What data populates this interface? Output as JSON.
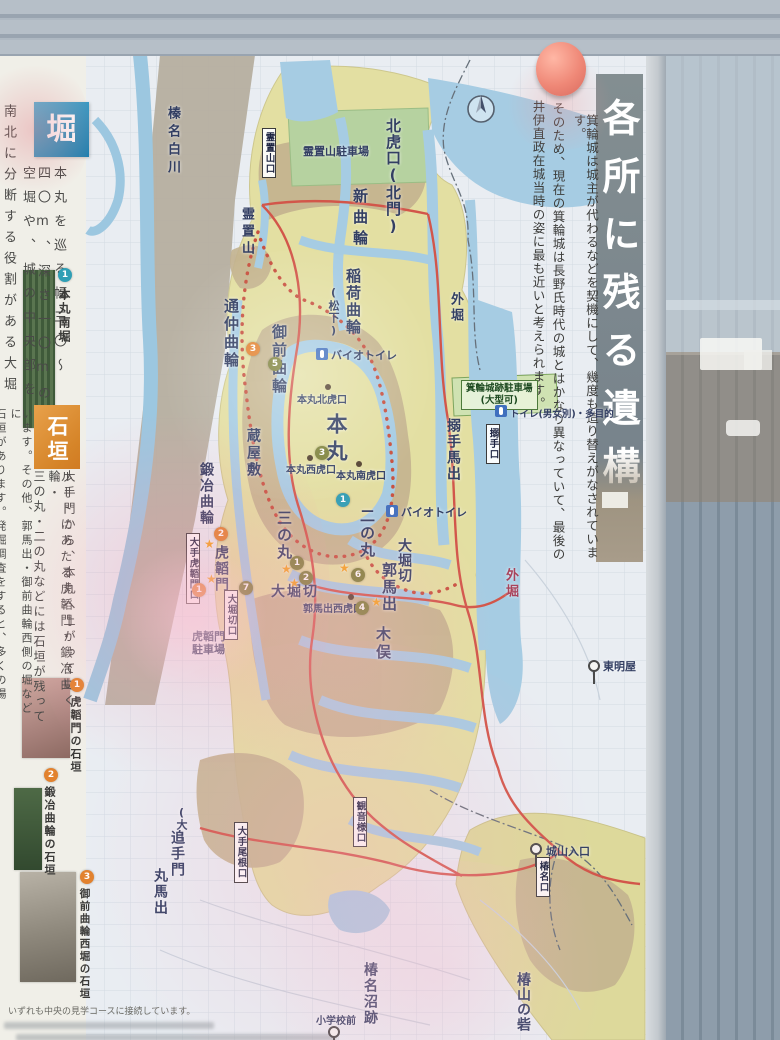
{
  "palette": {
    "banner": "#79848a",
    "hori_header": "#2f93bd",
    "ishigaki_header": "#d9872f",
    "marker_olive": "#7c8038",
    "marker_orange": "#e2822e",
    "marker_teal": "#2f9fb5",
    "road_red": "#d1544a"
  },
  "poster": {
    "banner_title": "各所に残る遺構",
    "intro": {
      "line1": "箕輪城は城主が代わるなどを契機にして、幾度も造り替えがなされています。",
      "line2": "そのため、現在の箕輪城は長野氏時代の城とはかなり異なっていて、最後の",
      "line3": "井伊直政在城当時の姿に最も近いと考えられます。"
    },
    "sidebar": {
      "hori": {
        "header": "堀",
        "lines": [
          "本丸を巡る幅三〇〜",
          "四〇m、深さ一〇mの",
          "空堀や、城の中央部を",
          "南北に分断する役割がある大堀"
        ],
        "photo": {
          "num": "1",
          "label": "本丸南堀"
        }
      },
      "ishigaki": {
        "header": "石垣",
        "lines": [
          "大手門から、本丸へ上がっていく",
          "ルートにあたる虎韜門・鍛冶曲輪・",
          "三の丸・二の丸などには石垣が残って",
          "います。その他、郭馬出・御前曲輪西側の堀などに",
          "石垣があります。発掘調査をすると、多くの場"
        ],
        "photos": [
          {
            "num": "1",
            "label": "虎韜門の石垣"
          },
          {
            "num": "2",
            "label": "鍛冶曲輪の石垣"
          },
          {
            "num": "3",
            "label": "御前曲輪西堀の石垣"
          }
        ]
      },
      "note": "いずれも中央の見学コースに接続しています。"
    },
    "map": {
      "labels": {
        "harunashirakawa": "榛名白川",
        "kitakoguchi": "北虎口(北門)",
        "shinkuruwa": "新曲輪",
        "reichiyama": "霊置山",
        "reichiyama_parking": "霊置山駐車場",
        "inarikuruwa": "稲荷曲輪",
        "matsushita": "(松下)",
        "gozenkuruwa": "御前曲輪",
        "toorinaka": "通仲曲輪",
        "honmaru": "本丸",
        "kurayashiki": "蔵屋敷",
        "kajikuruwa": "鍛冶曲輪",
        "honmaru_kita": "本丸北虎口",
        "honmaru_nishi": "本丸西虎口",
        "honmaru_minami": "本丸南虎口",
        "biotoilet1": "バイオトイレ",
        "biotoilet2": "バイオトイレ",
        "main_toilet": "トイレ(男女別)・多目的",
        "sotobori_n": "外堀",
        "sotobori_e": "外堀",
        "karamete_umadashi": "搦手馬出",
        "sannomaru": "三の丸",
        "ninomaru": "二の丸",
        "oohorikiri_w": "大堀切",
        "oohorikiri_e": "大堀切",
        "kaku_umadashi": "郭馬出",
        "kaku_umadashi_nishi": "郭馬出西虎口",
        "kimata": "木俣",
        "kotoumon": "虎韜門",
        "kotoumon_parking1": "虎韜門",
        "kotoumon_parking2": "駐車場",
        "toumyouya": "東明屋",
        "otemon_dai": "(大)",
        "otemon": "追手門",
        "maru_umadashi": "丸馬出",
        "shiroyama_iriguchi": "城山入口",
        "tsubakina_numa": "椿名沼跡",
        "tsubakiyama_toride": "椿山の砦",
        "shougakkou_mae": "小学校前"
      },
      "boxes": {
        "reichiyama_guchi": "霊置山口",
        "oote_kotoumon_guchi": "大手虎韜門口",
        "oohorikiri_guchi": "大堀切口",
        "karamete_guchi": "搦手口",
        "oote_one_guchi": "大手尾根口",
        "kannonsama_guchi": "観音様口",
        "tsubakina_guchi": "椿名口",
        "parking1": "箕輪城跡駐車場",
        "parking2": "(大型可)"
      },
      "markers": {
        "olive": [
          "1",
          "2",
          "3",
          "4",
          "5",
          "6",
          "7"
        ],
        "orange": [
          "1",
          "2",
          "3"
        ],
        "teal": [
          "1"
        ]
      }
    }
  }
}
